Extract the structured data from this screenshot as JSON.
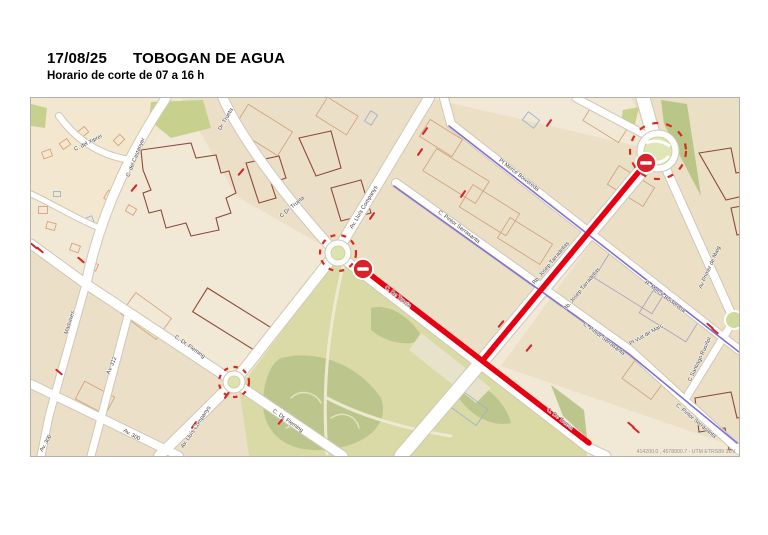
{
  "header": {
    "date": "17/08/25",
    "title": "TOBOGAN DE AGUA",
    "subtitle": "Horario de corte de 07 a 16 h"
  },
  "map": {
    "coordinates_text": "414200.0 , 4578000.7 - UTM ETRS89 31N",
    "closed_streets": [
      "C. De Trueta",
      "Rb. Josep Tarradellas"
    ],
    "colors": {
      "closure_red": "#e60012",
      "no_entry_sign_red": "#d8232a",
      "bike_lane_purple": "#8172d4",
      "park_green": "#d9daa6",
      "park_dark_green": "#bcc68c",
      "road_white": "#ffffff",
      "land_beige": "#f1e9d6"
    },
    "labels": [
      {
        "text": "C. del Xiprer",
        "x": 58,
        "y": 46,
        "r": -27
      },
      {
        "text": "C. del Castanyer",
        "x": 106,
        "y": 60,
        "r": -68
      },
      {
        "text": "Dr. Trueta",
        "x": 196,
        "y": 22,
        "r": -60
      },
      {
        "text": "C Dr. Trueta",
        "x": 262,
        "y": 110,
        "r": -40
      },
      {
        "text": "Av. Lluís Companys",
        "x": 334,
        "y": 110,
        "r": -59
      },
      {
        "text": "Pt Mercè Boixereda",
        "x": 487,
        "y": 78,
        "r": 38
      },
      {
        "text": "C. Pintor Serrasanta",
        "x": 427,
        "y": 130,
        "r": 37
      },
      {
        "text": "Rb. Josep Tarradellas",
        "x": 521,
        "y": 166,
        "r": -50
      },
      {
        "text": "Rb. Josep Tarradellas",
        "x": 552,
        "y": 192,
        "r": -50
      },
      {
        "text": "R. Mercè Boixereda",
        "x": 633,
        "y": 200,
        "r": 37
      },
      {
        "text": "Av Primer de Maig",
        "x": 680,
        "y": 170,
        "r": -66
      },
      {
        "text": "C Santiago Rusiñol",
        "x": 670,
        "y": 262,
        "r": -65
      },
      {
        "text": "Pl Vuit de Març",
        "x": 616,
        "y": 238,
        "r": -30
      },
      {
        "text": "C. Pintor Serrasanta",
        "x": 572,
        "y": 242,
        "r": 37
      },
      {
        "text": "C. Pintor Serrasanta",
        "x": 664,
        "y": 324,
        "r": 40
      },
      {
        "text": "C. De Trueta",
        "x": 366,
        "y": 200,
        "r": 38
      },
      {
        "text": "C. De Trueta",
        "x": 528,
        "y": 322,
        "r": 38
      },
      {
        "text": "C. Dr. Fleming",
        "x": 158,
        "y": 250,
        "r": 35
      },
      {
        "text": "C. Dr. Fleming",
        "x": 256,
        "y": 324,
        "r": 35
      },
      {
        "text": "Av. Lluís Companys",
        "x": 166,
        "y": 330,
        "r": -56
      },
      {
        "text": "Maduixes",
        "x": 40,
        "y": 225,
        "r": -73
      },
      {
        "text": "Av. 312",
        "x": 82,
        "y": 268,
        "r": -67
      },
      {
        "text": "Av. 300",
        "x": 100,
        "y": 338,
        "r": 30
      },
      {
        "text": "Av. 300",
        "x": 16,
        "y": 346,
        "r": -60
      }
    ]
  }
}
